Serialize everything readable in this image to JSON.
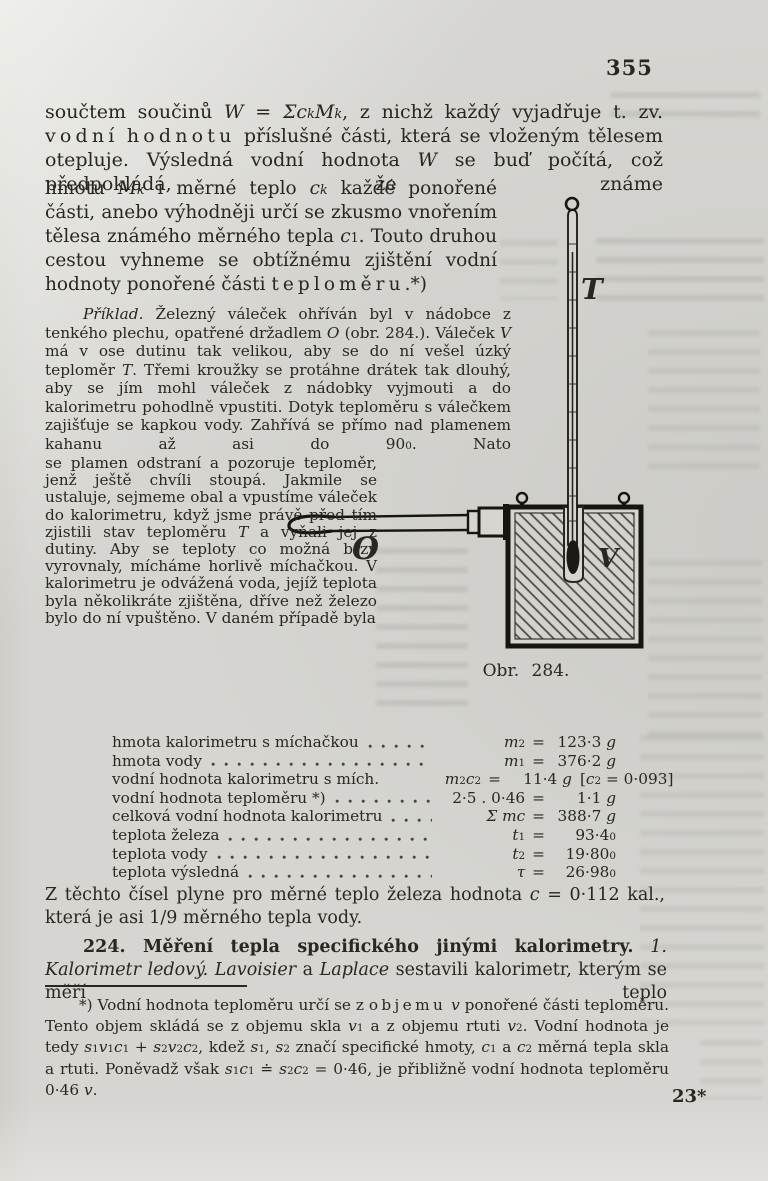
{
  "page": {
    "number": "355",
    "signature_mark": "23*",
    "paper_color": "#d6d5d1",
    "ink_color": "#2b2620"
  },
  "paragraphs": {
    "p1_wide": "součtem součinů <i>W</i> = <i>Σc<sub>k</sub>M<sub>k</sub></i>, z nichž každý vyjadřuje t. zv. <span class='sp'>vodní</span> <span class='sp'>hodnotu</span> příslušné části, která se vloženým tělesem otepluje. Výsledná vodní hodnota <i>W</i> se buď počítá, což předpokládá, že známe",
    "p1_narrow": "hmotu <i>M<sub>k</sub></i> i měrné teplo <i>c<sub>k</sub></i> každé ponořené části, anebo výhodněji určí se zkusmo vnořením tělesa známého měrného tepla <i>c</i><sub>1</sub>. Touto druhou cestou vyhneme se obtížnému zjištění vodní hodnoty ponořené části <span class='sp'>teploměru</span>.*)",
    "priklad_wide": "<i>Příklad.</i> Železný váleček ohříván byl v nádobce z tenkého plechu, opatřené držadlem <i>O</i> (obr. 284.). Váleček <i>V</i> má v ose dutinu tak velikou, aby se do ní vešel úzký teploměr <i>T</i>. Třemi kroužky se protáhne drátek tak dlouhý, aby se jím mohl váleček z nádobky vyjmouti a do kalorimetru pohodlně vpustiti. Dotyk teploměru s válečkem zajišťuje se kapkou vody. Zahřívá se přímo nad plamenem kahanu až asi do 90<sup>0</sup>. Nato",
    "priklad_narrow": "se plamen odstraní a pozoruje teploměr, jenž ještě chvíli stoupá. Jakmile se ustaluje, sejmeme obal a vpustíme váleček do kalorimetru, když jsme právě před tím zjistili stav teploměru <i>T</i> a vyňali jej z dutiny. Aby se teploty co možná brzy vyrovnaly, mícháme horlivě míchačkou. V kalorimetru je odvážená voda, jejíž teplota byla několikráte zjištěna, dříve než železo bylo do ní vpuštěno. V daném případě byla",
    "result": "Z těchto čísel plyne pro měrné teplo železa hodnota <i>c</i> = 0·112 kal., která je asi 1/9 měrného tepla vody.",
    "section224": "<b>224. Měření tepla specifického jinými kalorimetry.</b> <i>1. Kalorimetr ledový.</i> <i>Lavoisier</i> a <i>Laplace</i> sestavili kalorimetr, kterým se měří teplo",
    "footnote": "*) Vodní hodnota teploměru určí se z <span class='sp'>objemu</span> <i>v</i> ponořené části teploměru. Tento objem skládá se z objemu skla <i>v</i><sub>1</sub> a z objemu rtuti <i>v</i><sub>2</sub>. Vodní hodnota je tedy <i>s</i><sub>1</sub><i>v</i><sub>1</sub><i>c</i><sub>1</sub> + <i>s</i><sub>2</sub><i>v</i><sub>2</sub><i>c</i><sub>2</sub>, kdež <i>s</i><sub>1</sub>, <i>s</i><sub>2</sub> značí specifické hmoty, <i>c</i><sub>1</sub> a <i>c</i><sub>2</sub> měrná tepla skla a rtuti. Poněvadž však <i>s</i><sub>1</sub><i>c</i><sub>1</sub> ≐ <i>s</i><sub>2</sub><i>c</i><sub>2</sub> = 0·46, je přibližně vodní hodnota teploměru 0·46 <i>v</i>."
  },
  "table": {
    "equals": "=",
    "rows": [
      {
        "label": "hmota kalorimetru s míchačkou",
        "sym": "<i>m</i><sub>2</sub>",
        "value": "123·3 <i>g</i>",
        "note": ""
      },
      {
        "label": "hmota vody",
        "sym": "<i>m</i><sub>1</sub>",
        "value": "376·2 <i>g</i>",
        "note": ""
      },
      {
        "label": "vodní hodnota kalorimetru s mích.",
        "sym": "<i>m</i><sub>2</sub><i>c</i><sub>2</sub>",
        "value": "11·4 <i>g</i>",
        "note": "[<i>c</i><sub>2</sub> = 0·093]"
      },
      {
        "label": "vodní hodnota teploměru *)",
        "sym": "2·5 . 0·46",
        "value": "1·1 <i>g</i>",
        "note": ""
      },
      {
        "label": "celková vodní hodnota kalorimetru",
        "sym": "<i>Σ mc</i>",
        "value": "388·7 <i>g</i>",
        "note": ""
      },
      {
        "label": "teplota železa",
        "sym": "<i>t</i><sub>1</sub>",
        "value": "93·4<sup>0</sup>",
        "note": ""
      },
      {
        "label": "teplota vody",
        "sym": "<i>t</i><sub>2</sub>",
        "value": "19·80<sup>0</sup>",
        "note": ""
      },
      {
        "label": "teplota výsledná",
        "sym": "<i>τ</i>",
        "value": "26·98<sup>0</sup>",
        "note": ""
      }
    ]
  },
  "figure": {
    "caption": "Obr. 284.",
    "labels": {
      "thermometer": "T",
      "handle": "O",
      "cylinder": "V"
    }
  }
}
